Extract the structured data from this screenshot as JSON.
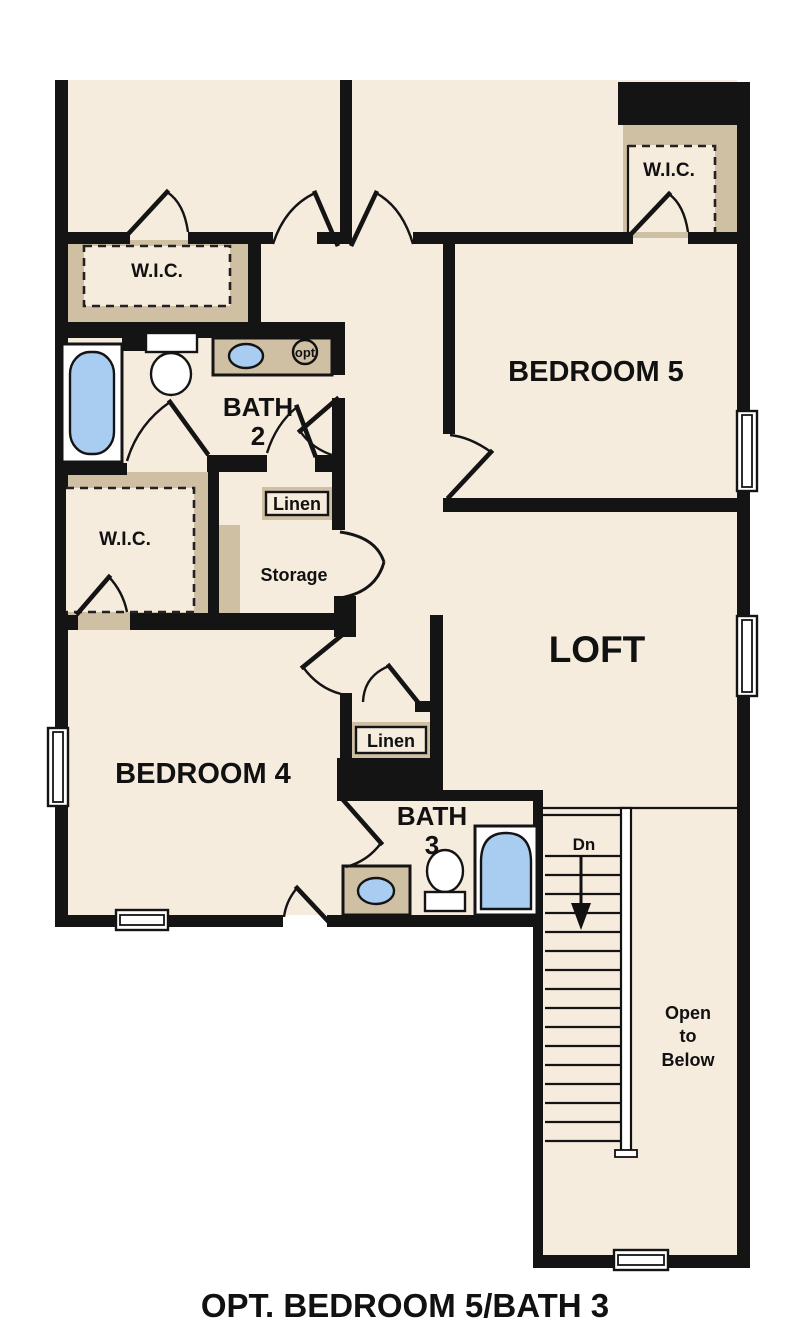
{
  "plan": {
    "caption": "OPT. BEDROOM 5/BATH 3",
    "rooms": {
      "bedroom5": "BEDROOM 5",
      "bedroom4": "BEDROOM 4",
      "loft": "LOFT",
      "bath2_line1": "BATH",
      "bath2_line2": "2",
      "bath3_line1": "BATH",
      "bath3_line2": "3",
      "wic_top_left": "W.I.C.",
      "wic_bedroom5": "W.I.C.",
      "wic_bedroom4": "W.I.C.",
      "linen_upper": "Linen",
      "linen_lower": "Linen",
      "storage": "Storage"
    },
    "stairs": {
      "down_label": "Dn",
      "open_line1": "Open",
      "open_line2": "to",
      "open_line3": "Below"
    },
    "fixtures": {
      "washer_opt_label": "opt"
    },
    "colors": {
      "background": "#ffffff",
      "floor": "#f6ecde",
      "closet_tan": "#cfc0a4",
      "wall": "#141414",
      "fixture_blue": "#a9cdf0",
      "text": "#111111"
    }
  }
}
